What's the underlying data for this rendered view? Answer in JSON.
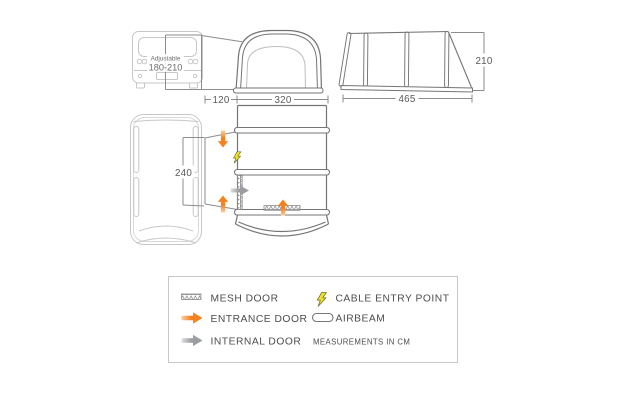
{
  "diagram": {
    "van_rear_label": {
      "line1": "Adjustable",
      "line2": "180-210"
    },
    "dims": {
      "tunnel_width": "120",
      "front_width": "320",
      "side_depth": "465",
      "height": "210",
      "van_side": "240"
    }
  },
  "legend": {
    "items": [
      {
        "id": "mesh-door",
        "label": "MESH DOOR"
      },
      {
        "id": "entrance-door",
        "label": "ENTRANCE DOOR"
      },
      {
        "id": "internal-door",
        "label": "INTERNAL DOOR"
      },
      {
        "id": "cable-entry-point",
        "label": "CABLE ENTRY POINT"
      },
      {
        "id": "airbeam",
        "label": "AIRBEAM"
      }
    ],
    "note": "MEASUREMENTS IN CM"
  },
  "colors": {
    "entrance_arrow": "#f5821f",
    "entrance_arrow_light": "#fbcfa4",
    "internal_arrow": "#9b9da0",
    "internal_arrow_light": "#e0e1e2",
    "cable_bolt": "#f2e41e",
    "tent_outline": "#757575",
    "van_outline": "#c6c7c9",
    "dimension_line": "#8a8c8e",
    "legend_border": "#c6c7c9",
    "text": "#4d4d4f"
  }
}
